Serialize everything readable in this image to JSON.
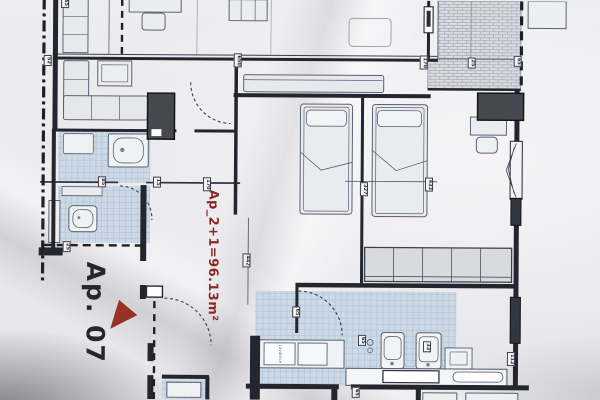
{
  "plan": {
    "apartment_label": "Ap. 07",
    "area_text": "Ap_2+1=96.13m²",
    "washer_text": "Lavatrice",
    "drawing_type": "apartment-floor-plan-photo"
  },
  "colors": {
    "paper": "#e9e9ec",
    "ink": "#23262e",
    "accent_red": "#8d2723",
    "triangle_red": "#993226",
    "tile_blue": "#cdd9e6",
    "dark_unit": "#45484f"
  },
  "dimension_labels": [
    {
      "text": "65",
      "x": 64,
      "y": 4
    },
    {
      "text": "52",
      "x": 47,
      "y": 62
    },
    {
      "text": "650",
      "x": 237,
      "y": 61
    },
    {
      "text": "170",
      "x": 423,
      "y": 62
    },
    {
      "text": "25",
      "x": 471,
      "y": 62
    },
    {
      "text": "65",
      "x": 517,
      "y": 60
    },
    {
      "text": "85",
      "x": 102,
      "y": 183
    },
    {
      "text": "15",
      "x": 157,
      "y": 183
    },
    {
      "text": "170",
      "x": 207,
      "y": 185
    },
    {
      "text": "327",
      "x": 364,
      "y": 189
    },
    {
      "text": "433",
      "x": 429,
      "y": 184
    },
    {
      "text": "442",
      "x": 247,
      "y": 261
    },
    {
      "text": "25",
      "x": 67,
      "y": 248
    },
    {
      "text": "65",
      "x": 297,
      "y": 312
    },
    {
      "text": "65",
      "x": 363,
      "y": 340
    },
    {
      "text": "33",
      "x": 428,
      "y": 346
    },
    {
      "text": "112",
      "x": 512,
      "y": 358
    },
    {
      "text": "65",
      "x": 357,
      "y": 392
    }
  ]
}
